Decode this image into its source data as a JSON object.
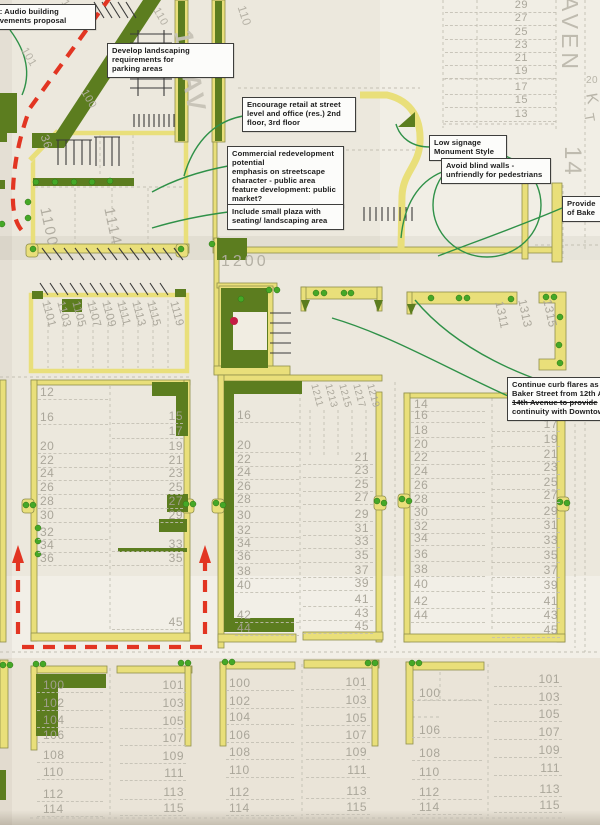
{
  "title": "Scanned streetscape improvement concept plan (Baker Street / 12th Avenue area)",
  "colors": {
    "paper": "#ece8dd",
    "yellow": "#e9df7a",
    "yellow_edge": "#8f8f4b",
    "dark_green": "#5c7d1f",
    "dot_green": "#45a827",
    "red": "#e23522",
    "red_dot": "#c41d44",
    "leader_green": "#2f9148",
    "gray_text": "#a5a195",
    "label_gray": "#c0bcb0",
    "hatch": "#3a3a3a",
    "lot_line": "#c3bfb3",
    "note_bg": "#fcfcfa",
    "note_border": "#3e3e3c",
    "note_text": "#1c1c1c"
  },
  "annotations": [
    {
      "id": "audio-building",
      "x": -10,
      "y": 4,
      "w": 96,
      "lines": [
        "d: Audio building",
        "ovements proposal"
      ]
    },
    {
      "id": "landscaping",
      "x": 107,
      "y": 43,
      "w": 117,
      "lines": [
        "Develop landscaping",
        "requirements for",
        "parking areas"
      ]
    },
    {
      "id": "retail",
      "x": 242,
      "y": 97,
      "w": 104,
      "lines": [
        "Encourage retail at street",
        "level and office (res.) 2nd",
        "floor, 3rd floor"
      ]
    },
    {
      "id": "commercial",
      "x": 227,
      "y": 146,
      "w": 107,
      "lines": [
        "Commercial redevelopment",
        "potential",
        "emphasis on streetscape",
        "character - public area",
        "feature development: public",
        "market?"
      ]
    },
    {
      "id": "plaza",
      "x": 227,
      "y": 204,
      "w": 107,
      "lines": [
        "Include small plaza with",
        "seating/ landscaping area"
      ]
    },
    {
      "id": "signage",
      "x": 429,
      "y": 135,
      "w": 68,
      "lines": [
        "Low signage",
        "Monument Style"
      ]
    },
    {
      "id": "blind-walls",
      "x": 441,
      "y": 158,
      "w": 100,
      "lines": [
        "Avoid blind walls -",
        "unfriendly for pedestrians"
      ]
    },
    {
      "id": "provide",
      "x": 562,
      "y": 196,
      "w": 62,
      "lines": [
        "Provide",
        "of Bake"
      ]
    },
    {
      "id": "curb-flares",
      "x": 507,
      "y": 377,
      "w": 112,
      "strike": 2,
      "lines": [
        "Continue curb flares as on",
        "Baker Street from 12th Av",
        "14th Avenue to provide",
        "continuity with Downtown"
      ]
    }
  ],
  "rotated_labels": [
    {
      "t": "12  AV",
      "x": 196,
      "y": 28,
      "rot": 80,
      "size": 26,
      "c": "#c7c3b7",
      "ls": 3,
      "bold": true
    },
    {
      "t": "AVEN",
      "x": 581,
      "y": -4,
      "rot": 90,
      "size": 23,
      "c": "#bdb9ad",
      "ls": 4
    },
    {
      "t": "14",
      "x": 584,
      "y": 146,
      "rot": 90,
      "size": 24,
      "c": "#bdb9ad",
      "ls": 2
    },
    {
      "t": "K",
      "x": 598,
      "y": 92,
      "rot": 80,
      "size": 16,
      "c": "#b5b1a5"
    },
    {
      "t": "T",
      "x": 596,
      "y": 112,
      "rot": 80,
      "size": 14,
      "c": "#b5b1a5"
    },
    {
      "t": "20",
      "x": 586,
      "y": 76,
      "rot": 0,
      "size": 10,
      "c": "#b5b1a5"
    },
    {
      "t": "1200",
      "x": 221,
      "y": 254,
      "rot": 0,
      "size": 16,
      "c": "#b2aea2",
      "ls": 3
    },
    {
      "t": "1100",
      "x": 52,
      "y": 206,
      "rot": 78,
      "size": 15,
      "c": "#aeaa9e",
      "ls": 2
    },
    {
      "t": "1114",
      "x": 116,
      "y": 206,
      "rot": 78,
      "size": 15,
      "c": "#aeaa9e",
      "ls": 2
    },
    {
      "t": "36",
      "x": 50,
      "y": 133,
      "rot": 72,
      "size": 12,
      "c": "#b4b0a4"
    },
    {
      "t": "110",
      "x": 247,
      "y": 4,
      "rot": 72,
      "size": 12,
      "c": "#b4b0a4"
    },
    {
      "t": "111",
      "x": 68,
      "y": -2,
      "rot": 60,
      "size": 11,
      "c": "#b4b0a4"
    },
    {
      "t": "101",
      "x": 28,
      "y": 46,
      "rot": 60,
      "size": 11,
      "c": "#b4b0a4"
    },
    {
      "t": "100",
      "x": 88,
      "y": 88,
      "rot": 60,
      "size": 11,
      "c": "#b4b0a4"
    },
    {
      "t": "110",
      "x": 160,
      "y": 6,
      "rot": 60,
      "size": 11,
      "c": "#b4b0a4"
    },
    {
      "t": "1101",
      "x": 50,
      "y": 300,
      "rot": 75,
      "size": 11.5,
      "c": "#a8a498"
    },
    {
      "t": "1103",
      "x": 65,
      "y": 300,
      "rot": 75,
      "size": 11.5,
      "c": "#a8a498"
    },
    {
      "t": "1105",
      "x": 80,
      "y": 300,
      "rot": 75,
      "size": 11.5,
      "c": "#a8a498"
    },
    {
      "t": "1107",
      "x": 95,
      "y": 300,
      "rot": 75,
      "size": 11.5,
      "c": "#a8a498"
    },
    {
      "t": "1109",
      "x": 110,
      "y": 300,
      "rot": 75,
      "size": 11.5,
      "c": "#a8a498"
    },
    {
      "t": "1111",
      "x": 125,
      "y": 300,
      "rot": 75,
      "size": 11.5,
      "c": "#a8a498"
    },
    {
      "t": "1113",
      "x": 140,
      "y": 300,
      "rot": 75,
      "size": 11.5,
      "c": "#a8a498"
    },
    {
      "t": "1115",
      "x": 155,
      "y": 300,
      "rot": 75,
      "size": 11.5,
      "c": "#a8a498"
    },
    {
      "t": "1119",
      "x": 178,
      "y": 300,
      "rot": 75,
      "size": 11.5,
      "c": "#a8a498"
    },
    {
      "t": "1211",
      "x": 318,
      "y": 383,
      "rot": 75,
      "size": 10,
      "c": "#a8a498"
    },
    {
      "t": "1213",
      "x": 332,
      "y": 383,
      "rot": 75,
      "size": 10,
      "c": "#a8a498"
    },
    {
      "t": "1215",
      "x": 346,
      "y": 383,
      "rot": 75,
      "size": 10,
      "c": "#a8a498"
    },
    {
      "t": "1217",
      "x": 360,
      "y": 383,
      "rot": 75,
      "size": 10,
      "c": "#a8a498"
    },
    {
      "t": "1219",
      "x": 374,
      "y": 383,
      "rot": 75,
      "size": 10,
      "c": "#a8a498"
    },
    {
      "t": "1311",
      "x": 505,
      "y": 300,
      "rot": 78,
      "size": 12,
      "c": "#a8a498"
    },
    {
      "t": "1313",
      "x": 528,
      "y": 298,
      "rot": 78,
      "size": 12,
      "c": "#a8a498"
    },
    {
      "t": "1315",
      "x": 553,
      "y": 298,
      "rot": 78,
      "size": 12,
      "c": "#a8a498"
    }
  ],
  "lot_columns": [
    {
      "name": "top-right-odd",
      "x": 528,
      "w": 20,
      "align": "right",
      "size": 11,
      "line": {
        "x": 445,
        "w": 111
      },
      "entries": [
        [
          "29",
          0
        ],
        [
          "27",
          13
        ],
        [
          "25",
          27
        ],
        [
          "23",
          40
        ],
        [
          "21",
          53
        ],
        [
          "19",
          66
        ],
        [
          "17",
          82
        ],
        [
          "15",
          95
        ],
        [
          "13",
          109
        ]
      ]
    },
    {
      "name": "block-a-even",
      "x": 40,
      "size": 12,
      "line": {
        "x": 38,
        "w": 70
      },
      "entries": [
        [
          "12",
          386
        ],
        [
          "16",
          411
        ],
        [
          "20",
          440
        ],
        [
          "22",
          454
        ],
        [
          "24",
          467
        ],
        [
          "26",
          481
        ],
        [
          "28",
          495
        ],
        [
          "30",
          509
        ],
        [
          "32",
          526
        ],
        [
          "34",
          539
        ],
        [
          "36",
          552
        ]
      ]
    },
    {
      "name": "block-a-odd",
      "x": 183,
      "w": 30,
      "align": "right",
      "size": 12,
      "line": {
        "x": 112,
        "w": 71
      },
      "entries": [
        [
          "15",
          410
        ],
        [
          "17",
          425
        ],
        [
          "19",
          440
        ],
        [
          "21",
          454
        ],
        [
          "23",
          467
        ],
        [
          "25",
          481
        ],
        [
          "27",
          495
        ],
        [
          "29",
          509
        ],
        [
          "33",
          538
        ],
        [
          "35",
          552
        ],
        [
          "45",
          616
        ]
      ]
    },
    {
      "name": "block-b-even",
      "x": 237,
      "size": 12,
      "line": {
        "x": 235,
        "w": 64
      },
      "entries": [
        [
          "16",
          409
        ],
        [
          "20",
          439
        ],
        [
          "22",
          453
        ],
        [
          "24",
          466
        ],
        [
          "26",
          480
        ],
        [
          "28",
          493
        ],
        [
          "30",
          509
        ],
        [
          "32",
          524
        ],
        [
          "34",
          537
        ],
        [
          "36",
          550
        ],
        [
          "38",
          565
        ],
        [
          "40",
          579
        ],
        [
          "42",
          609
        ],
        [
          "44",
          622
        ]
      ]
    },
    {
      "name": "block-b-odd",
      "x": 369,
      "w": 30,
      "align": "right",
      "size": 12,
      "line": {
        "x": 303,
        "w": 70
      },
      "entries": [
        [
          "21",
          451
        ],
        [
          "23",
          464
        ],
        [
          "25",
          478
        ],
        [
          "27",
          491
        ],
        [
          "29",
          508
        ],
        [
          "31",
          522
        ],
        [
          "33",
          535
        ],
        [
          "35",
          549
        ],
        [
          "37",
          564
        ],
        [
          "39",
          577
        ],
        [
          "41",
          593
        ],
        [
          "43",
          607
        ],
        [
          "45",
          620
        ]
      ]
    },
    {
      "name": "block-c-even",
      "x": 414,
      "size": 12,
      "line": {
        "x": 411,
        "w": 74
      },
      "entries": [
        [
          "14",
          398
        ],
        [
          "16",
          409
        ],
        [
          "18",
          424
        ],
        [
          "20",
          438
        ],
        [
          "22",
          451
        ],
        [
          "24",
          465
        ],
        [
          "26",
          479
        ],
        [
          "28",
          493
        ],
        [
          "30",
          506
        ],
        [
          "32",
          520
        ],
        [
          "34",
          532
        ],
        [
          "36",
          548
        ],
        [
          "38",
          563
        ],
        [
          "40",
          578
        ],
        [
          "42",
          595
        ],
        [
          "44",
          609
        ]
      ]
    },
    {
      "name": "block-c-odd",
      "x": 558,
      "w": 30,
      "align": "right",
      "size": 12,
      "line": {
        "x": 492,
        "w": 68
      },
      "entries": [
        [
          "17",
          418
        ],
        [
          "19",
          433
        ],
        [
          "21",
          448
        ],
        [
          "23",
          461
        ],
        [
          "25",
          476
        ],
        [
          "27",
          489
        ],
        [
          "29",
          505
        ],
        [
          "31",
          519
        ],
        [
          "33",
          534
        ],
        [
          "35",
          549
        ],
        [
          "37",
          564
        ],
        [
          "39",
          579
        ],
        [
          "41",
          595
        ],
        [
          "43",
          609
        ],
        [
          "45",
          624
        ]
      ]
    },
    {
      "name": "block-f-even",
      "x": 43,
      "size": 12,
      "line": {
        "x": 37,
        "w": 66
      },
      "entries": [
        [
          "100",
          679
        ],
        [
          "102",
          697
        ],
        [
          "104",
          714
        ],
        [
          "106",
          729
        ],
        [
          "108",
          749
        ],
        [
          "110",
          766
        ],
        [
          "112",
          788
        ],
        [
          "114",
          803
        ]
      ]
    },
    {
      "name": "block-g-odd",
      "x": 184,
      "w": 35,
      "align": "right",
      "size": 12,
      "line": {
        "x": 120,
        "w": 66
      },
      "entries": [
        [
          "101",
          679
        ],
        [
          "103",
          697
        ],
        [
          "105",
          715
        ],
        [
          "107",
          732
        ],
        [
          "109",
          750
        ],
        [
          "111",
          767
        ],
        [
          "113",
          786
        ],
        [
          "115",
          802
        ]
      ]
    },
    {
      "name": "block-h-even",
      "x": 229,
      "size": 12,
      "line": {
        "x": 226,
        "w": 68
      },
      "entries": [
        [
          "100",
          677
        ],
        [
          "102",
          695
        ],
        [
          "104",
          711
        ],
        [
          "106",
          729
        ],
        [
          "108",
          746
        ],
        [
          "110",
          764
        ],
        [
          "112",
          786
        ],
        [
          "114",
          802
        ]
      ]
    },
    {
      "name": "block-i-odd",
      "x": 367,
      "w": 35,
      "align": "right",
      "size": 12,
      "line": {
        "x": 306,
        "w": 64
      },
      "entries": [
        [
          "101",
          676
        ],
        [
          "103",
          694
        ],
        [
          "105",
          712
        ],
        [
          "107",
          729
        ],
        [
          "109",
          746
        ],
        [
          "111",
          764
        ],
        [
          "113",
          785
        ],
        [
          "115",
          801
        ]
      ]
    },
    {
      "name": "block-j-even",
      "x": 419,
      "size": 12,
      "line": {
        "x": 412,
        "w": 70
      },
      "entries": [
        [
          "100",
          687
        ],
        [
          "106",
          724
        ],
        [
          "108",
          747
        ],
        [
          "110",
          766
        ],
        [
          "112",
          786
        ],
        [
          "114",
          801
        ]
      ]
    },
    {
      "name": "block-k-odd",
      "x": 560,
      "w": 35,
      "align": "right",
      "size": 12,
      "line": {
        "x": 494,
        "w": 68
      },
      "entries": [
        [
          "101",
          673
        ],
        [
          "103",
          691
        ],
        [
          "105",
          708
        ],
        [
          "107",
          726
        ],
        [
          "109",
          744
        ],
        [
          "111",
          762
        ],
        [
          "113",
          783
        ],
        [
          "115",
          799
        ]
      ]
    }
  ]
}
